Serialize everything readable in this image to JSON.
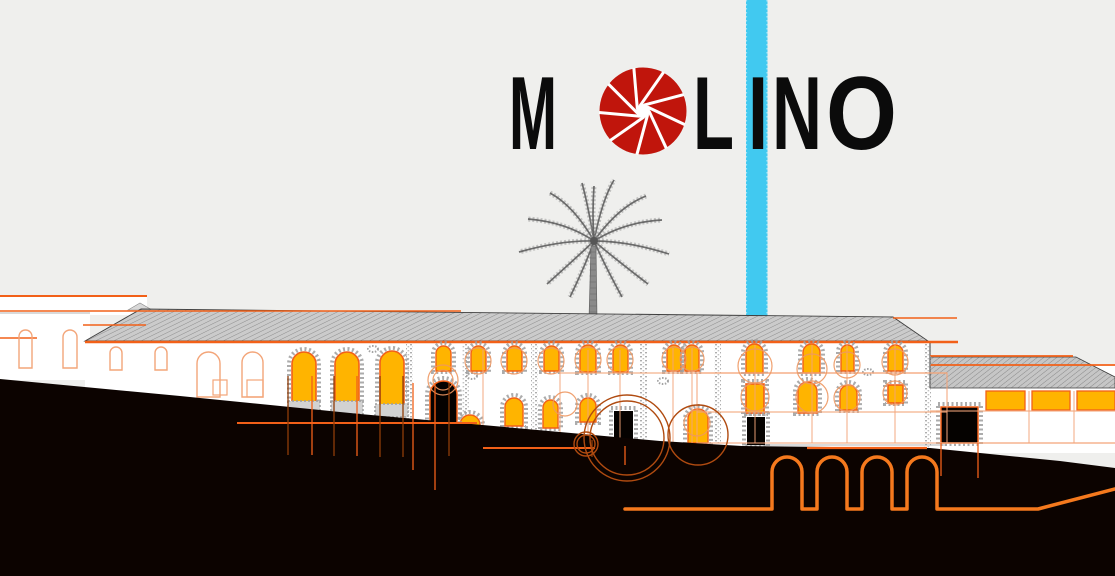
{
  "title": {
    "word": "MOLINO",
    "letters": [
      {
        "ch": "M",
        "x": 509,
        "w": 48
      },
      {
        "ch": "L",
        "x": 693,
        "w": 41
      },
      {
        "ch": "I",
        "x": 748,
        "w": 20
      },
      {
        "ch": "N",
        "x": 772,
        "w": 50
      },
      {
        "ch": "O",
        "x": 826,
        "w": 71
      }
    ],
    "baseline": 149,
    "font_size": 104,
    "aperture_icon": {
      "cx": 643,
      "cy": 111,
      "r": 43.5,
      "hole_r": 7,
      "blades": 9,
      "tilt": 58
    }
  },
  "colors": {
    "background": "#efefed",
    "cyan": "#41c9f0",
    "logo": "#0b0b0b",
    "aperture_red": "#c0150c",
    "amber": "#ffb400",
    "orange": "#f26018",
    "orange_bright": "#f5791d",
    "pale": "#f3a579",
    "circle_orange": "#ee9760",
    "rust": "#8f3c08",
    "rust_circle": "#b04b10",
    "ground": "#0c0300",
    "stone": "#9e9e9e",
    "white": "#ffffff",
    "palm_gray": "#6f6f6f"
  },
  "illustration": {
    "stripe": {
      "x": 746,
      "y": 0,
      "w": 21.5,
      "h": 319
    },
    "wall_blocks": [
      [
        0,
        296,
        147,
        19
      ],
      [
        0,
        313,
        90,
        67
      ],
      [
        85,
        341,
        845,
        110
      ],
      [
        930,
        364,
        185,
        89
      ]
    ],
    "main_roof": {
      "pts": "85,341 141,309 893,317 928,341",
      "peak": "128,310 140,303 152,310"
    },
    "annex_roof": {
      "pts": "930,357 1076,357 1115,377 1115,388 930,388"
    },
    "corner_line": [
      930,
      341,
      930,
      388
    ],
    "orange_lines_front": [
      [
        0,
        296,
        147,
        2
      ],
      [
        0,
        311,
        461,
        1.6
      ],
      [
        83,
        325,
        146,
        1.6
      ],
      [
        0,
        338,
        37,
        1.6
      ],
      [
        85,
        342,
        958,
        2.4
      ],
      [
        893,
        318,
        957,
        1.6
      ],
      [
        930,
        356,
        1073,
        1.8
      ],
      [
        930,
        365,
        1115,
        1.8
      ]
    ],
    "gray_lines": [
      [
        742,
        445,
        947
      ],
      [
        0,
        313,
        90
      ]
    ],
    "outline_arches": [
      [
        19,
        330,
        13,
        38
      ],
      [
        63,
        330,
        14,
        38
      ],
      [
        110,
        347,
        12,
        23
      ],
      [
        155,
        347,
        12,
        23
      ],
      [
        197,
        352,
        23,
        45
      ],
      [
        242,
        352,
        21,
        45
      ]
    ],
    "outline_rects": [
      [
        213,
        380,
        14,
        15
      ],
      [
        247,
        380,
        16,
        17
      ]
    ],
    "big_arches": [
      [
        292,
        352,
        24,
        50
      ],
      [
        335,
        352,
        24,
        50
      ],
      [
        380,
        351,
        24,
        54
      ]
    ],
    "sills": [
      [
        288,
        401,
        32,
        13
      ],
      [
        331,
        401,
        32,
        13
      ],
      [
        375,
        404,
        33,
        13
      ]
    ],
    "upper_windows": [
      [
        436,
        346,
        15,
        25
      ],
      [
        471,
        346,
        15,
        25
      ],
      [
        507,
        346,
        15,
        25
      ],
      [
        544,
        346,
        15,
        25
      ],
      [
        580,
        345,
        16,
        27
      ],
      [
        613,
        345,
        15,
        27
      ],
      [
        667,
        345,
        14,
        26
      ],
      [
        685,
        345,
        14,
        26
      ],
      [
        746,
        344,
        17,
        29
      ],
      [
        803,
        344,
        17,
        29
      ],
      [
        841,
        345,
        13,
        26
      ],
      [
        888,
        345,
        15,
        26
      ]
    ],
    "second_windows_arch": [
      [
        505,
        398,
        18,
        28
      ],
      [
        543,
        400,
        15,
        28
      ],
      [
        580,
        398,
        16,
        24
      ],
      [
        688,
        409,
        20,
        34
      ],
      [
        798,
        382,
        19,
        31
      ],
      [
        840,
        385,
        17,
        25
      ],
      [
        460,
        415,
        20,
        17
      ]
    ],
    "second_windows_rect": [
      [
        746,
        384,
        18,
        29
      ],
      [
        888,
        385,
        15,
        18
      ]
    ],
    "annex_windows": [
      [
        986,
        391,
        39,
        19
      ],
      [
        1032,
        391,
        38,
        19
      ],
      [
        1077,
        391,
        38,
        19
      ]
    ],
    "door_main": [
      430,
      381,
      27,
      42
    ],
    "doors_rect": [
      [
        614,
        411,
        19,
        34
      ],
      [
        747,
        417,
        18,
        28
      ],
      [
        941,
        407,
        37,
        36
      ]
    ],
    "pilasters": [
      [
        406,
        344,
        86
      ],
      [
        462,
        344,
        90
      ],
      [
        531,
        344,
        94
      ],
      [
        640,
        344,
        99
      ],
      [
        714,
        344,
        100
      ],
      [
        924,
        344,
        104
      ]
    ],
    "stone_patches": [
      [
        472,
        376
      ],
      [
        663,
        381
      ],
      [
        373,
        349
      ],
      [
        868,
        372
      ]
    ],
    "pale_h_lines": [
      [
        560,
        373,
        947
      ],
      [
        697,
        412,
        947
      ],
      [
        930,
        411,
        1115
      ]
    ],
    "pale_v_lines": [
      [
        588,
        350,
        443
      ],
      [
        620,
        350,
        443
      ],
      [
        673,
        348,
        443
      ],
      [
        692,
        348,
        443
      ],
      [
        755,
        345,
        443
      ],
      [
        812,
        345,
        443
      ],
      [
        847,
        345,
        443
      ],
      [
        895,
        345,
        443
      ],
      [
        1029,
        391,
        443
      ],
      [
        1074,
        391,
        443
      ],
      [
        483,
        350,
        445
      ],
      [
        560,
        350,
        443
      ]
    ],
    "pale_rect": [
      697,
      373,
      250,
      70
    ],
    "pale_circles": [
      [
        443,
        380,
        15
      ],
      [
        443,
        380,
        10
      ],
      [
        478,
        361,
        13
      ],
      [
        514,
        361,
        13
      ],
      [
        551,
        361,
        13
      ],
      [
        588,
        360,
        13
      ],
      [
        620,
        360,
        13
      ],
      [
        674,
        359,
        12
      ],
      [
        692,
        359,
        12
      ],
      [
        755,
        366,
        17
      ],
      [
        812,
        369,
        15
      ],
      [
        847,
        365,
        13
      ],
      [
        895,
        362,
        13
      ],
      [
        755,
        397,
        14
      ],
      [
        812,
        397,
        16
      ],
      [
        847,
        398,
        13
      ],
      [
        895,
        393,
        12
      ],
      [
        565,
        404,
        12
      ],
      [
        697,
        423,
        13
      ]
    ],
    "ground_pts": "0,379 180,396 360,414 560,432 660,441 742,446 930,448 980,453 1060,461 1115,468 1115,576 0,576",
    "post_black_lines_bright": [
      [
        237,
        423,
        477,
        2
      ],
      [
        483,
        448,
        595,
        2
      ],
      [
        807,
        448,
        927,
        2.2
      ]
    ],
    "post_black_lines_pale": [
      [
        940,
        443,
        1115,
        1.2
      ]
    ],
    "drop_lines": [
      [
        288,
        376,
        455,
        "d"
      ],
      [
        312,
        376,
        455,
        "b"
      ],
      [
        334,
        376,
        456,
        "d"
      ],
      [
        357,
        376,
        456,
        "b"
      ],
      [
        380,
        376,
        457,
        "d"
      ],
      [
        403,
        376,
        457,
        "d"
      ],
      [
        413,
        383,
        470,
        "b"
      ],
      [
        435,
        383,
        490,
        "b"
      ],
      [
        449,
        383,
        456,
        "d"
      ],
      [
        592,
        440,
        457,
        "d"
      ],
      [
        625,
        446,
        465,
        "b"
      ],
      [
        941,
        443,
        476,
        "b"
      ],
      [
        978,
        443,
        478,
        "b"
      ]
    ],
    "big_circles": [
      [
        627,
        438,
        43
      ],
      [
        627,
        438,
        37
      ],
      [
        698,
        435,
        30
      ],
      [
        586,
        444,
        12
      ],
      [
        586,
        444,
        9
      ]
    ],
    "arcade": {
      "start_x": 625,
      "base_y": 509,
      "arch_xs": [
        772,
        817,
        862,
        907
      ],
      "arch_w": 30,
      "spring_y": 472,
      "r": 15,
      "flat_to": 1038,
      "end_x": 1115,
      "end_y": 489,
      "stroke_w": 3.5
    },
    "palm": {
      "trunk": "589,319 597,319 596,246 591,246",
      "center": [
        594,
        241
      ],
      "fronds": [
        [
          588,
          205,
          582,
          183
        ],
        [
          602,
          200,
          614,
          180
        ],
        [
          574,
          206,
          550,
          193
        ],
        [
          618,
          207,
          646,
          196
        ],
        [
          566,
          222,
          528,
          219
        ],
        [
          624,
          222,
          662,
          220
        ],
        [
          562,
          240,
          519,
          252
        ],
        [
          628,
          241,
          669,
          254
        ],
        [
          576,
          258,
          547,
          284
        ],
        [
          614,
          258,
          648,
          284
        ],
        [
          586,
          264,
          570,
          297
        ],
        [
          604,
          264,
          622,
          297
        ],
        [
          592,
          215,
          594,
          186
        ]
      ]
    }
  }
}
